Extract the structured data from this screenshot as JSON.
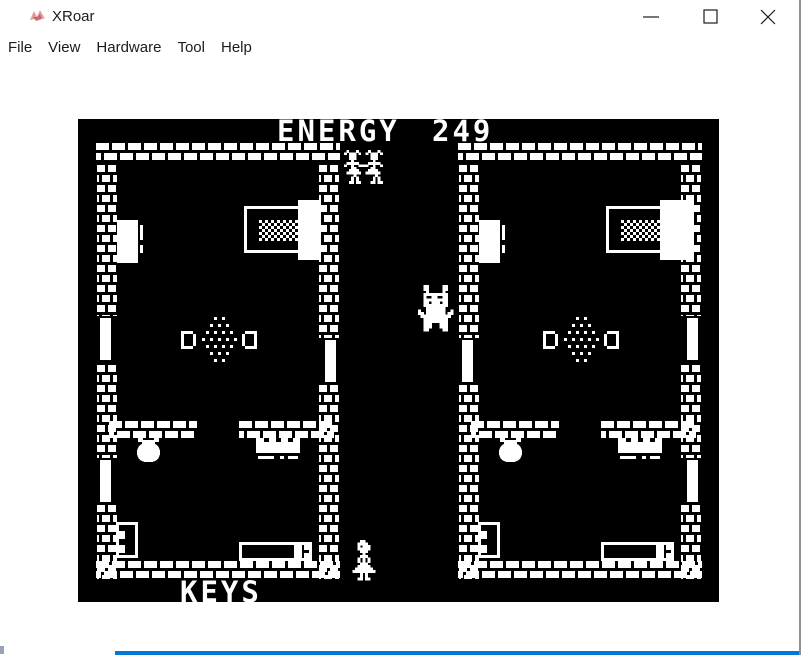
{
  "window": {
    "title": "XRoar",
    "controls": [
      {
        "name": "minimize"
      },
      {
        "name": "maximize"
      },
      {
        "name": "close"
      }
    ]
  },
  "menu_bar": {
    "items": [
      {
        "label": "File"
      },
      {
        "label": "View"
      },
      {
        "label": "Hardware"
      },
      {
        "label": "Tool"
      },
      {
        "label": "Help"
      }
    ]
  },
  "colors": {
    "screen_bg": "#000000",
    "screen_fg": "#ffffff",
    "chrome_text": "#1c1c1c",
    "window_border": "#8f8f8f",
    "accent_bottom": "#0078d7",
    "icon_red_light": "#e39a9e",
    "icon_red_dark": "#c05a60"
  },
  "emulator_screen": {
    "x": 78,
    "y": 119,
    "w": 641,
    "h": 483,
    "hud": {
      "energy_label": "ENERGY",
      "energy_value": "249",
      "keys_label": "KEYS"
    },
    "objects": [
      {
        "type": "hwall",
        "x": 17,
        "y": 23,
        "w": 246,
        "h": 22,
        "name": "wall-top-left-room"
      },
      {
        "type": "vwall",
        "x": 18,
        "y": 45,
        "w": 22,
        "h": 416,
        "name": "wall-left-outer"
      },
      {
        "type": "vwall",
        "x": 240,
        "y": 45,
        "w": 22,
        "h": 416,
        "name": "wall-left-corridor"
      },
      {
        "type": "hwall",
        "x": 30,
        "y": 301,
        "w": 90,
        "h": 20,
        "name": "wall-inner-left-a"
      },
      {
        "type": "hwall",
        "x": 160,
        "y": 301,
        "w": 97,
        "h": 20,
        "name": "wall-inner-left-b"
      },
      {
        "type": "hwall",
        "x": 17,
        "y": 441,
        "w": 246,
        "h": 20,
        "name": "wall-bottom-left-room"
      },
      {
        "type": "hwall",
        "x": 379,
        "y": 23,
        "w": 246,
        "h": 22,
        "name": "wall-top-right-room"
      },
      {
        "type": "vwall",
        "x": 380,
        "y": 45,
        "w": 22,
        "h": 416,
        "name": "wall-right-corridor"
      },
      {
        "type": "vwall",
        "x": 602,
        "y": 45,
        "w": 22,
        "h": 416,
        "name": "wall-right-outer"
      },
      {
        "type": "hwall",
        "x": 392,
        "y": 301,
        "w": 90,
        "h": 20,
        "name": "wall-inner-right-a"
      },
      {
        "type": "hwall",
        "x": 522,
        "y": 301,
        "w": 97,
        "h": 20,
        "name": "wall-inner-right-b"
      },
      {
        "type": "hwall",
        "x": 379,
        "y": 441,
        "w": 246,
        "h": 20,
        "name": "wall-bottom-right-room"
      },
      {
        "type": "door",
        "x": 18,
        "y": 197,
        "w": 22,
        "h": 46,
        "side": "left",
        "name": "door"
      },
      {
        "type": "door",
        "x": 18,
        "y": 339,
        "w": 22,
        "h": 46,
        "side": "left",
        "name": "door"
      },
      {
        "type": "door",
        "x": 240,
        "y": 219,
        "w": 22,
        "h": 46,
        "side": "right",
        "name": "door"
      },
      {
        "type": "door",
        "x": 380,
        "y": 219,
        "w": 22,
        "h": 46,
        "side": "left",
        "name": "door"
      },
      {
        "type": "door",
        "x": 602,
        "y": 197,
        "w": 22,
        "h": 46,
        "side": "right",
        "name": "door"
      },
      {
        "type": "door",
        "x": 602,
        "y": 339,
        "w": 22,
        "h": 46,
        "side": "right",
        "name": "door"
      },
      {
        "type": "wardrobe",
        "x": 39,
        "y": 101,
        "w": 21,
        "h": 43,
        "name": "wardrobe"
      },
      {
        "type": "bed",
        "x": 166,
        "y": 87,
        "w": 57,
        "h": 47,
        "headW": 23,
        "name": "bed"
      },
      {
        "type": "rug",
        "cx": 141,
        "cy": 220,
        "name": "rug"
      },
      {
        "type": "bracketL",
        "x": 103,
        "y": 212,
        "name": "seat"
      },
      {
        "type": "bracketR",
        "x": 163,
        "y": 212,
        "name": "seat"
      },
      {
        "type": "pot",
        "x": 58,
        "y": 319,
        "name": "cauldron"
      },
      {
        "type": "shelf",
        "x": 178,
        "y": 319,
        "name": "shelf"
      },
      {
        "type": "chair",
        "x": 38,
        "y": 403,
        "name": "chair"
      },
      {
        "type": "table",
        "x": 161,
        "y": 423,
        "name": "table"
      },
      {
        "type": "wardrobe",
        "x": 401,
        "y": 101,
        "w": 21,
        "h": 43,
        "name": "wardrobe"
      },
      {
        "type": "bed",
        "x": 528,
        "y": 87,
        "w": 57,
        "h": 47,
        "headW": 34,
        "name": "bed"
      },
      {
        "type": "rug",
        "cx": 503,
        "cy": 220,
        "name": "rug"
      },
      {
        "type": "bracketL",
        "x": 465,
        "y": 212,
        "name": "seat"
      },
      {
        "type": "bracketR",
        "x": 525,
        "y": 212,
        "name": "seat"
      },
      {
        "type": "pot",
        "x": 420,
        "y": 319,
        "name": "cauldron"
      },
      {
        "type": "shelf",
        "x": 540,
        "y": 319,
        "name": "shelf"
      },
      {
        "type": "chair",
        "x": 400,
        "y": 403,
        "name": "chair"
      },
      {
        "type": "table",
        "x": 523,
        "y": 423,
        "name": "table"
      },
      {
        "type": "sprite",
        "sprite": "girls",
        "x": 266,
        "y": 31,
        "px": 2.4,
        "name": "sprite-girls"
      },
      {
        "type": "sprite",
        "sprite": "monster",
        "x": 340,
        "y": 166,
        "px": 2.7,
        "name": "sprite-monster"
      },
      {
        "type": "sprite",
        "sprite": "witch",
        "x": 272,
        "y": 421,
        "px": 2.5,
        "name": "sprite-witch"
      },
      {
        "type": "text",
        "bind": "energy_label",
        "x": 199,
        "y": 22,
        "name": "hud-energy-label"
      },
      {
        "type": "text",
        "bind": "energy_value",
        "x": 354,
        "y": 22,
        "name": "hud-energy-value"
      },
      {
        "type": "text",
        "bind": "keys_label",
        "x": 102,
        "y": 483,
        "name": "hud-keys-label"
      }
    ],
    "sprites": {
      "girls": [
        ".X...X....X...X.",
        "X.XXX.X..X.XXX.X",
        "..XXX......XXX..",
        "..XXX......XXX..",
        "...X........X...",
        ".XXXXX....XXXXX.",
        "X..X..XXXX..X..X",
        "...XX......XX...",
        "..XXXX....XXXX..",
        ".XXXXXX..XXXXXX.",
        "....X........X..",
        "...X.X......X.X.",
        "...X.X......X.X.",
        "..XX.XX....XX.XX"
      ],
      "monster": [
        "..XX.....XX...",
        "..XX.....XX...",
        "...X.....X....",
        "..XXXXXXXXX...",
        "..X..XX..XX...",
        "..XXXXXXXXX...",
        "..XX.XXX.XX...",
        "..XXXXXXXXX...",
        "...XXXXXXX....",
        "X..XXXXXXX..X.",
        "XX.XXXXXXX.XX.",
        ".XXXXXXXXXXX..",
        "..XXXXXXXXX...",
        "..XXXXXXXXX...",
        "..XXX...XXX...",
        "..XXX...XXX...",
        "..XX.....XX..."
      ],
      "witch": [
        "....XX.....",
        "...XXXX....",
        "...X.XXX...",
        "...XXXXX...",
        "....XXX....",
        ".....X.....",
        "....XXX....",
        "...X.X.X...",
        "...X.X.X...",
        "....XXX....",
        "...XXXXX...",
        "..XXXXXXX..",
        ".XXXXXXXXX.",
        "....X.X....",
        "....X.X....",
        "...XX.XX..."
      ]
    }
  }
}
